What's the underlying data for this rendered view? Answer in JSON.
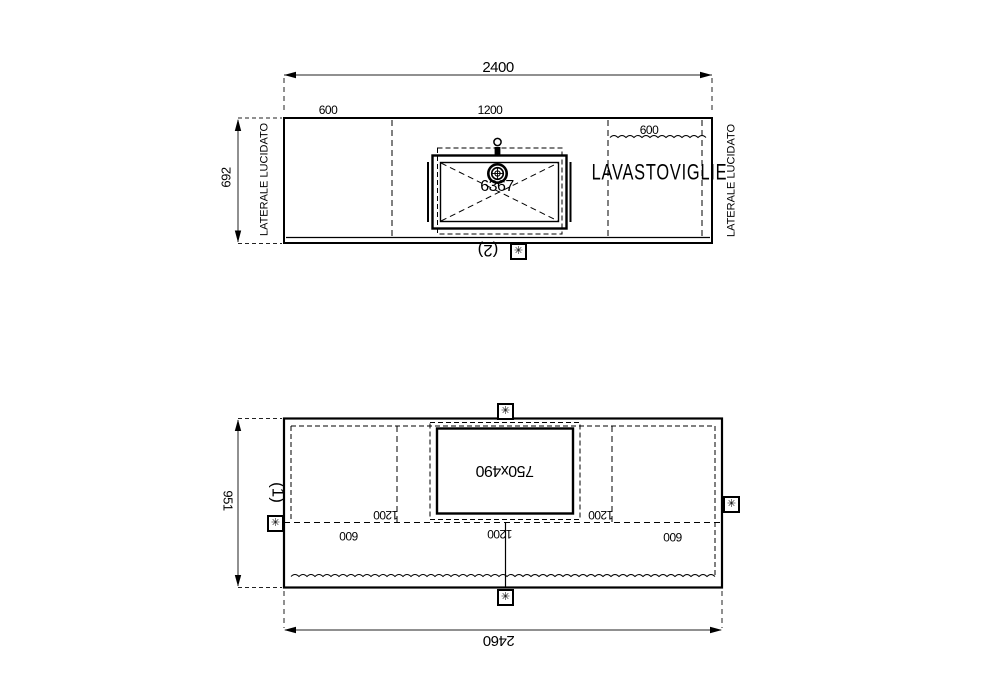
{
  "colors": {
    "line": "#000000",
    "background": "#ffffff"
  },
  "symbols": {
    "join_marker": "✳"
  },
  "top_view": {
    "overall_width": "2400",
    "depth": "692",
    "segment_600": "600",
    "segment_1200": "1200",
    "dishwasher_width": "600",
    "left_side_label": "LATERALE LUCIDATO",
    "right_side_label": "LATERALE LUCIDATO",
    "appliance": "LAVASTOVIGLIE",
    "sink_code": "6367",
    "piece_number": "(2)"
  },
  "bottom_view": {
    "overall_width": "2460",
    "depth": "951",
    "cutout_size": "750x490",
    "segment_left_1200": "1200",
    "segment_right_1200": "1200",
    "offset_left_600": "600",
    "offset_center_1200": "1200",
    "offset_right_600": "600",
    "piece_number": "(1)"
  }
}
